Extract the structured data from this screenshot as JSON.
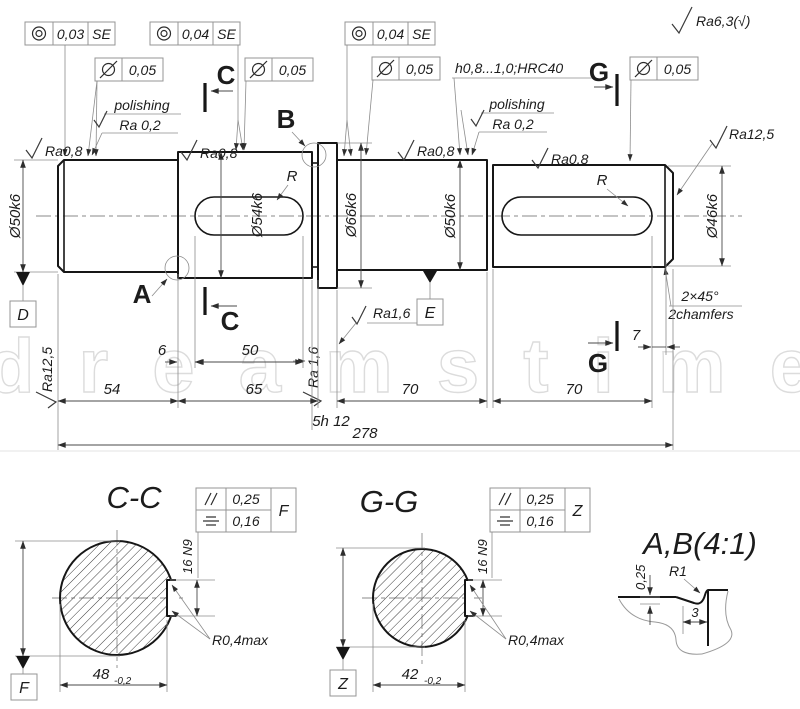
{
  "watermark": {
    "text": "dreamstime"
  },
  "notes": {
    "general_roughness": "Ra6,3(√)",
    "hardness": "h0,8...1,0;HRC40",
    "polishing_line1": "polishing",
    "polishing_line2": "Ra 0,2",
    "chamfer_line1": "2×45°",
    "chamfer_line2": "2chamfers"
  },
  "roughness": {
    "ra08": "Ra0,8",
    "ra125": "Ra12,5",
    "ra16": "Ra1,6",
    "ra16_spaced": "Ra 1,6"
  },
  "tolerance_frames": {
    "concentricity1": {
      "value": "0,03",
      "datum": "SE"
    },
    "concentricity2": {
      "value": "0,04",
      "datum": "SE"
    },
    "concentricity3": {
      "value": "0,04",
      "datum": "SE"
    },
    "cylindricity": {
      "value": "0,05"
    }
  },
  "shaft": {
    "diameters": [
      "Ø50k6",
      "Ø54k6",
      "Ø66k6",
      "Ø50k6",
      "Ø46k6"
    ],
    "keyway_radius_label": "R"
  },
  "dimensions": {
    "d6": "6",
    "d50": "50",
    "d54": "54",
    "d65": "65",
    "d70": "70",
    "d7": "7",
    "d278": "278",
    "groove": "5h 12"
  },
  "markers": {
    "a": "A",
    "b": "B",
    "c": "C",
    "g": "G"
  },
  "datums": {
    "d": "D",
    "e": "E",
    "f": "F",
    "z": "Z"
  },
  "section_cc": {
    "title": "C-C",
    "frame": {
      "parallelism": "0,25",
      "symmetry": "0,16",
      "datum": "F"
    },
    "keyway_width": "16 N9",
    "fillet_note": "R0,4max",
    "width_value": "48",
    "width_tol": "-0,2"
  },
  "section_gg": {
    "title": "G-G",
    "frame": {
      "parallelism": "0,25",
      "symmetry": "0,16",
      "datum": "Z"
    },
    "keyway_width": "16 N9",
    "fillet_note": "R0,4max",
    "width_value": "42",
    "width_tol": "-0,2"
  },
  "detail_ab": {
    "title": "A,B(4:1)",
    "radius": "R1",
    "depth": "0,25",
    "width": "3"
  }
}
